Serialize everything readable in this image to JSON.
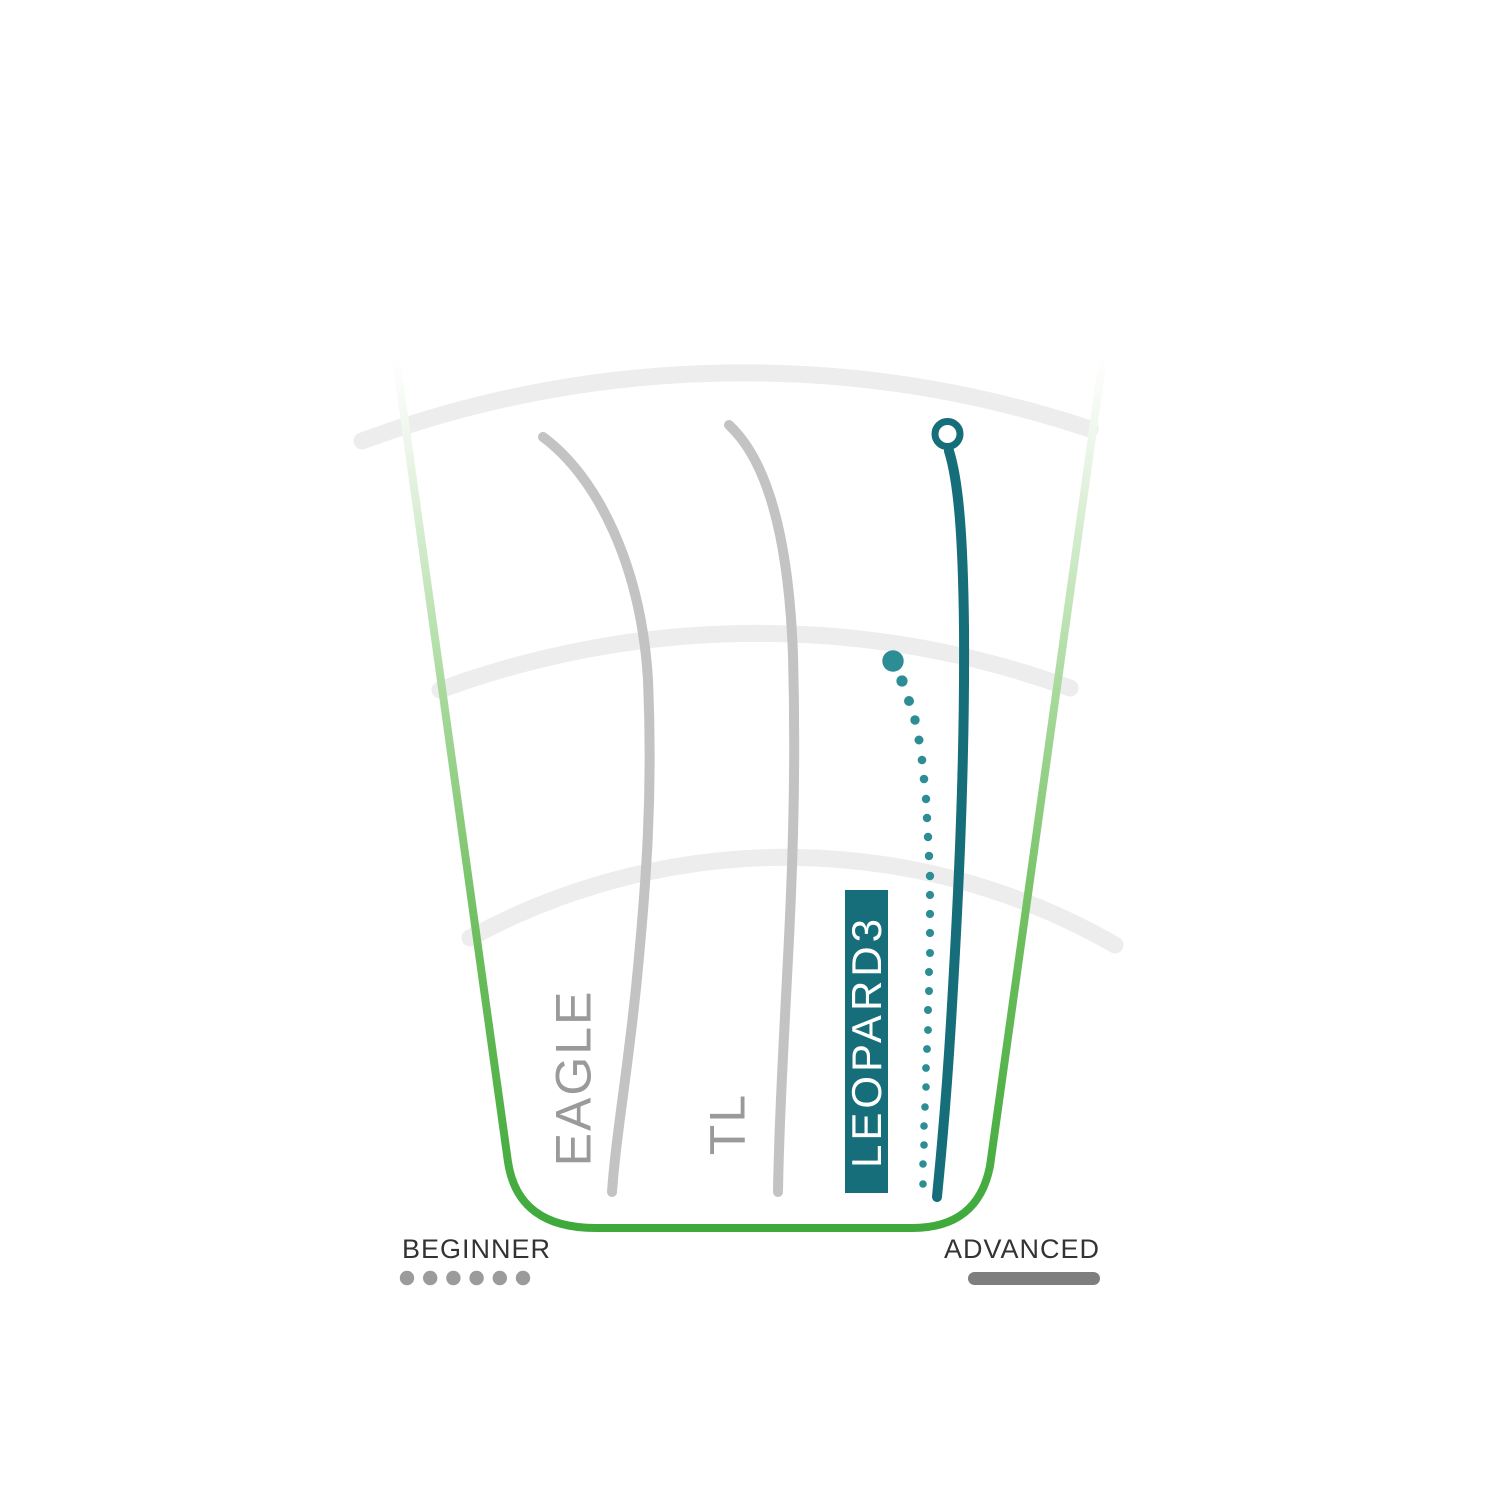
{
  "page": {
    "background": "#FFFFFF"
  },
  "colors": {
    "fairway_green": "#3FA93C",
    "line_gray": "#C3C3C3",
    "label_gray": "#9A9A9A",
    "arc_gray": "#EDEDED",
    "teal": "#156E79",
    "teal_dots": "#2D8D95",
    "marker_fill": "#FFFFFF",
    "legend_text": "#333333",
    "legend_dot_gray": "#9B9B9B",
    "legend_bar_gray": "#7E7E7E",
    "label_text_on_teal": "#FFFFFF"
  },
  "chart_data": {
    "type": "line",
    "title": "",
    "legend": {
      "left": "BEGINNER",
      "right": "ADVANCED",
      "beginner_dot_count": 6
    },
    "series": [
      {
        "name": "EAGLE",
        "line_style": "solid",
        "color": "#C3C3C3",
        "stroke_width": 10,
        "path": "M 543 437 C 597 477 641 565 648 680 C 653 795 646 885 637 978 C 628 1070 616 1135 612 1192",
        "label": {
          "x": 573,
          "y": 1078,
          "font_size": 50,
          "rotation": -90
        }
      },
      {
        "name": "TL",
        "line_style": "solid",
        "color": "#C3C3C3",
        "stroke_width": 10,
        "path": "M 729 425 C 770 463 789 545 793 655 C 796 765 793 862 788 958 C 783 1055 779 1128 778 1192",
        "label": {
          "x": 727,
          "y": 1124,
          "font_size": 50,
          "rotation": -90
        }
      },
      {
        "name": "LEOPARD3",
        "line_style": "solid-with-dotted-companion",
        "highlighted": true,
        "color": "#156E79",
        "stroke_width": 10,
        "path": "M 949 451 C 959 483 963 540 964 628 C 965 770 958 905 951 1022 C 945 1122 939 1174 937 1197",
        "marker": {
          "cx": 947.5,
          "cy": 434,
          "r": 12.5,
          "stroke_width": 7
        },
        "dots_color": "#2D8D95",
        "dots": [
          [
            893,
            661,
            10.7
          ],
          [
            902,
            681,
            5.6
          ],
          [
            909,
            701,
            5.0
          ],
          [
            915,
            720,
            4.7
          ],
          [
            919,
            740,
            4.5
          ],
          [
            922,
            760,
            4.3
          ],
          [
            924,
            779,
            4.3
          ],
          [
            926,
            799,
            4.2
          ],
          [
            927,
            818,
            4.2
          ],
          [
            928,
            837,
            4.2
          ],
          [
            929,
            856,
            4.2
          ],
          [
            930,
            876,
            4.2
          ],
          [
            930,
            895,
            4.1
          ],
          [
            930,
            914,
            4.1
          ],
          [
            930,
            933,
            4.1
          ],
          [
            930,
            953,
            4.0
          ],
          [
            929,
            972,
            4.0
          ],
          [
            929,
            991,
            4.0
          ],
          [
            928,
            1010,
            4.0
          ],
          [
            928,
            1030,
            3.9
          ],
          [
            927,
            1049,
            3.9
          ],
          [
            926,
            1068,
            3.9
          ],
          [
            926,
            1087,
            3.8
          ],
          [
            925,
            1107,
            3.8
          ],
          [
            924,
            1126,
            3.8
          ],
          [
            924,
            1145,
            3.8
          ],
          [
            923,
            1164,
            3.8
          ],
          [
            923,
            1184,
            3.8
          ]
        ],
        "label_box": {
          "x": 845,
          "y": 890,
          "width": 43,
          "height": 303,
          "fill": "#156E79",
          "text_color": "#FFFFFF",
          "font_size": 42,
          "letter_spacing": 4
        }
      }
    ],
    "field": {
      "funnel_path": "M 396 358 L 508 1162 Q 518 1228 596 1228 L 912 1228 Q 978 1228 990 1166 L 1103 358",
      "border_width": 8,
      "gradient_stops": [
        [
          "0%",
          "#FFFFFF"
        ],
        [
          "10%",
          "#EDF6EA"
        ],
        [
          "38%",
          "#A9DA9D"
        ],
        [
          "68%",
          "#6BBD5B"
        ],
        [
          "100%",
          "#3FA93C"
        ]
      ],
      "arc_width": 17,
      "arcs": [
        "M 362 441 A 1100 1100 0 0 1 1090 429",
        "M 440 690 A 920 920 0 0 1 1070 688",
        "M 470 938 A 660 660 0 0 1 1115 945"
      ]
    },
    "legend_geometry": {
      "beginner_text": {
        "x": 402,
        "y": 1258
      },
      "beginner_dots": {
        "cx_start": 407,
        "cx_step": 23.2,
        "cy": 1278,
        "r": 7.2
      },
      "advanced_text": {
        "x": 1100,
        "y": 1258
      },
      "advanced_bar": {
        "x": 968,
        "y": 1272,
        "width": 132,
        "height": 13,
        "rx": 6.5
      }
    }
  }
}
